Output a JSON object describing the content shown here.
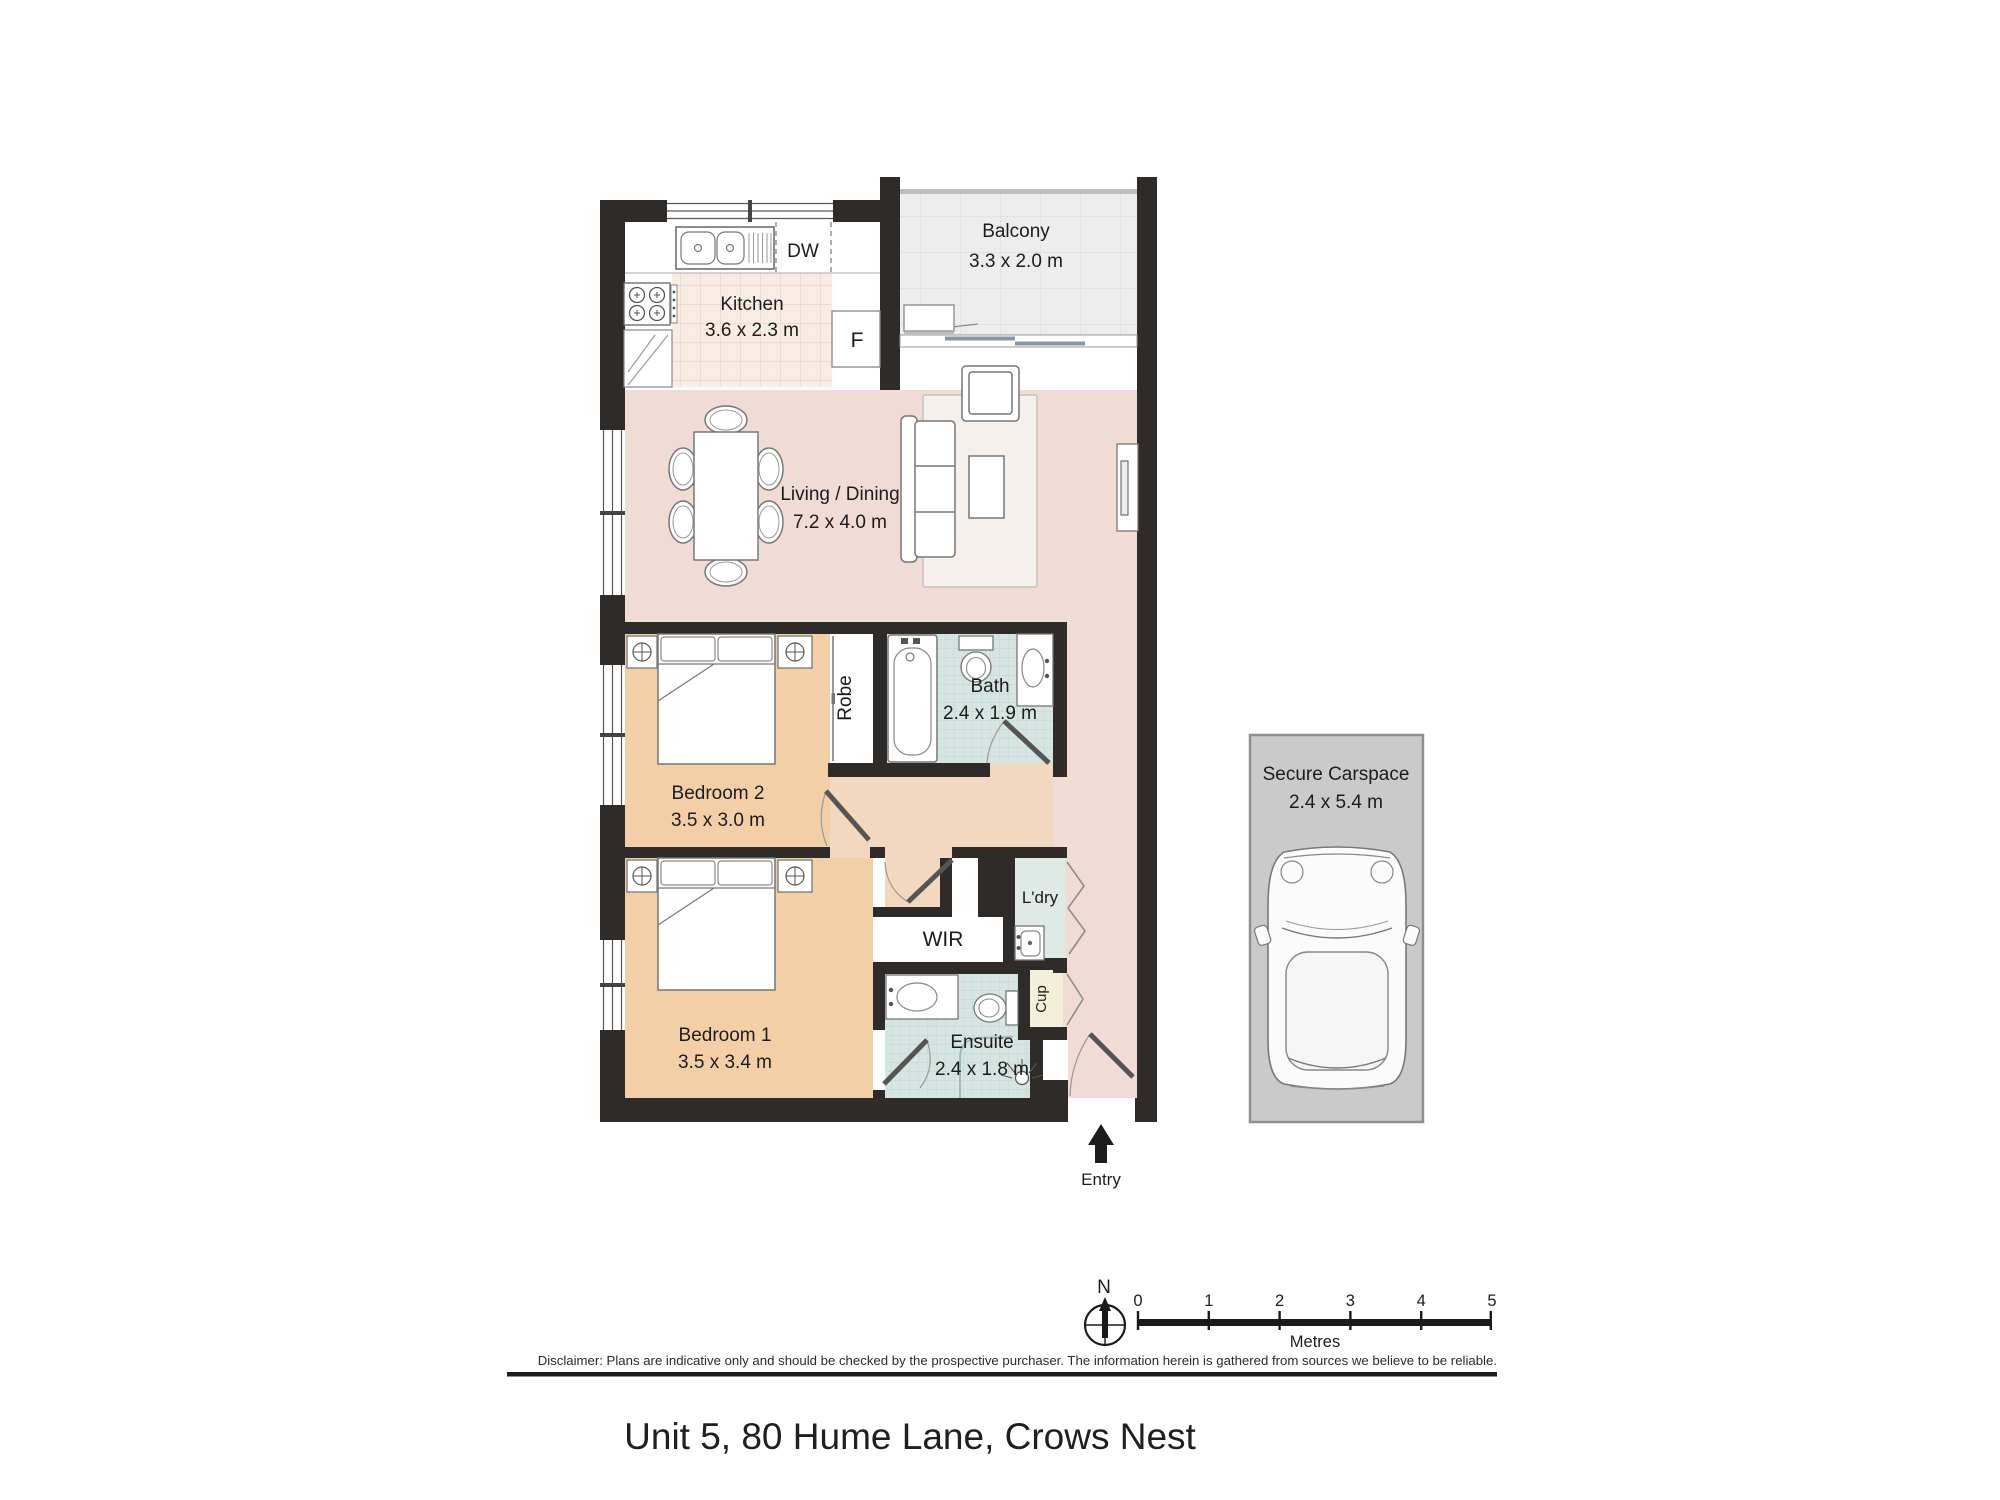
{
  "title": "Unit 5, 80 Hume Lane, Crows Nest",
  "disclaimer": "Disclaimer: Plans are indicative only and should be checked by the prospective purchaser. The information herein is gathered from sources we believe to be reliable.",
  "rooms": {
    "kitchen": {
      "name": "Kitchen",
      "dims": "3.6 x 2.3 m"
    },
    "balcony": {
      "name": "Balcony",
      "dims": "3.3 x 2.0 m"
    },
    "living": {
      "name": "Living / Dining",
      "dims": "7.2 x 4.0 m"
    },
    "bedroom2": {
      "name": "Bedroom 2",
      "dims": "3.5 x 3.0 m"
    },
    "bath": {
      "name": "Bath",
      "dims": "2.4 x 1.9 m"
    },
    "bedroom1": {
      "name": "Bedroom 1",
      "dims": "3.5 x 3.4 m"
    },
    "ensuite": {
      "name": "Ensuite",
      "dims": "2.4 x 1.8 m"
    },
    "robe": {
      "name": "Robe"
    },
    "wir": {
      "name": "WIR"
    },
    "laundry": {
      "name": "L'dry"
    },
    "cupboard": {
      "name": "Cup"
    },
    "carspace": {
      "name": "Secure Carspace",
      "dims": "2.4 x 5.4 m"
    }
  },
  "labels": {
    "dishwasher": "DW",
    "fridge": "F",
    "entry": "Entry",
    "north": "N",
    "metres": "Metres"
  },
  "scale_bar": {
    "ticks": [
      "0",
      "1",
      "2",
      "3",
      "4",
      "5"
    ],
    "unit_label": "Metres"
  },
  "colors": {
    "wall": "#2e2b29",
    "living_floor": "#f1dbd5",
    "bedroom_floor": "#f3cfa7",
    "hall_floor": "#f3d8c0",
    "bath_floor": "#d6e5e2",
    "laundry_floor": "#dfeae7",
    "cupboard_floor": "#f4efd8",
    "kitchen_floor": "#f9ece3",
    "balcony_floor": "#ededed",
    "carspace_fill": "#cacaca"
  }
}
